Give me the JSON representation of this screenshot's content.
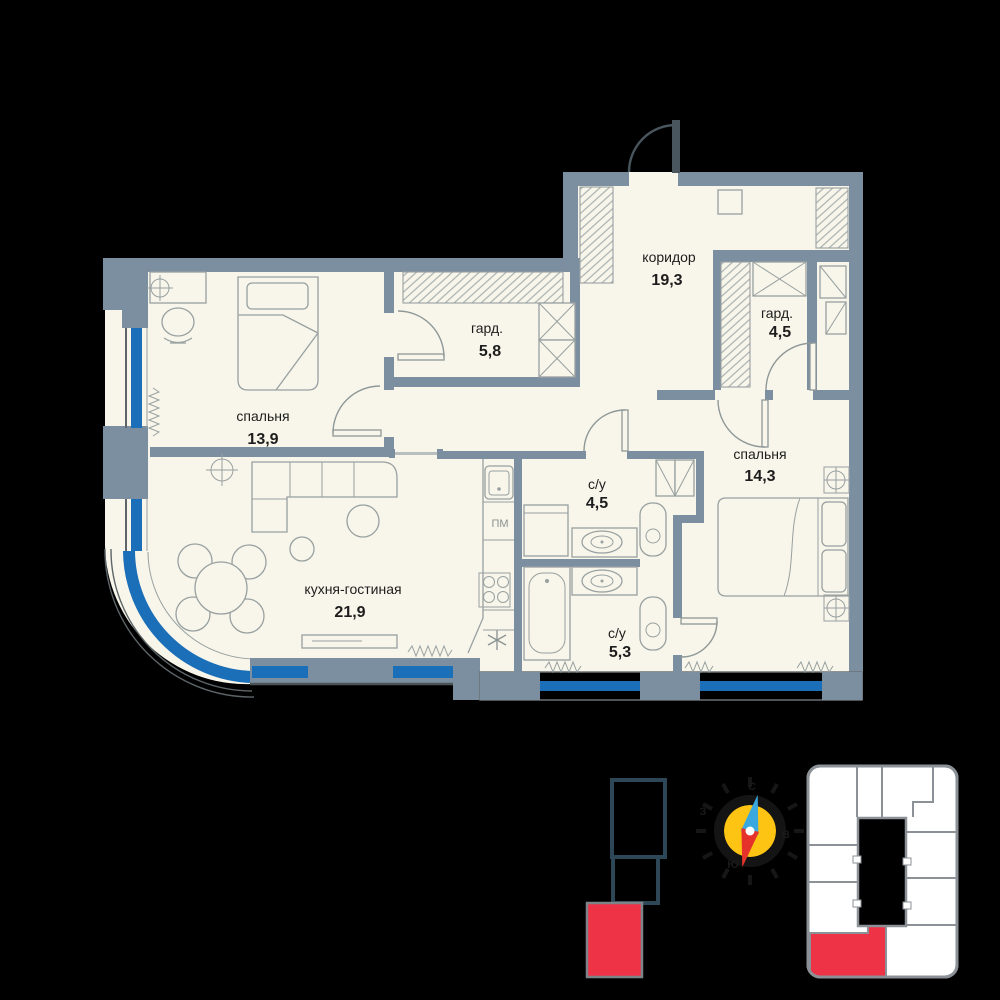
{
  "plan": {
    "rooms": [
      {
        "key": "bedroom-1",
        "label": "спальня",
        "area": "13,9"
      },
      {
        "key": "wardrobe-1",
        "label": "гард.",
        "area": "5,8"
      },
      {
        "key": "corridor",
        "label": "коридор",
        "area": "19,3"
      },
      {
        "key": "wardrobe-2",
        "label": "гард.",
        "area": "4,5"
      },
      {
        "key": "bedroom-2",
        "label": "спальня",
        "area": "14,3"
      },
      {
        "key": "bathroom-1",
        "label": "с/у",
        "area": "4,5"
      },
      {
        "key": "bathroom-2",
        "label": "с/у",
        "area": "5,3"
      },
      {
        "key": "kitchen-living",
        "label": "кухня-гостиная",
        "area": "21,9"
      }
    ],
    "appliances": {
      "dishwasher": "ПМ"
    }
  },
  "compass": {
    "north": "С",
    "east": "В",
    "south": "Ю",
    "west": "З"
  },
  "colors": {
    "background": "#000000",
    "room_fill": "#f8f6ea",
    "wall": "#7c8fa0",
    "wall_dark": "#49565e",
    "line": "#98a0a0",
    "facade": "#5d6568",
    "glazing_blue": "#1b6eb8",
    "text": "#1d1d1d",
    "red": "#ee3347",
    "compass_yellow": "#fdc413",
    "needle_blue": "#38a8de",
    "needle_red": "#e5332b",
    "minimap_line": "#8b9196",
    "section_outline": "#2e4757"
  }
}
